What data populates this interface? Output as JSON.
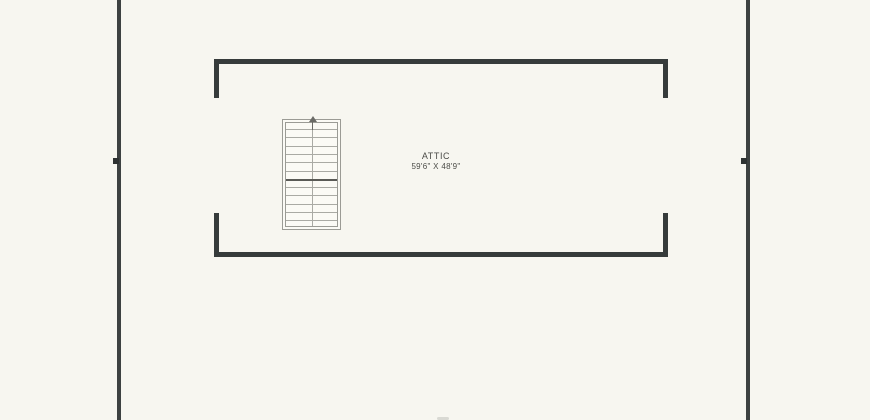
{
  "plan": {
    "room_label": "ATTIC",
    "room_dimensions": "59'6\" X 48'9\"",
    "stairs": {
      "tread_count": 12,
      "landing_index": 6,
      "first_tread_offset": 6,
      "tread_spacing": 8.3,
      "direction": "up"
    }
  },
  "colors": {
    "background": "#f7f6f0",
    "exterior_wall": "#3d4141",
    "interior_wall": "#363b3b",
    "stair_outline": "#9b9b95",
    "stair_tread": "#aaaaa4",
    "stair_landing": "#5a5a56",
    "label_text": "#4b4b47"
  }
}
